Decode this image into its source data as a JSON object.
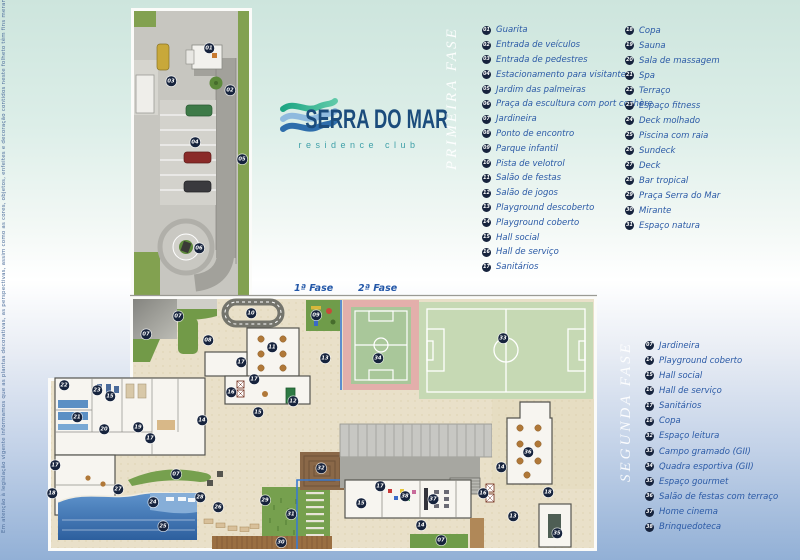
{
  "disclaimer": "Em atenção à legislação vigente informamos que as plantas decorativas, as perspectivas, assim como as cores, objetos, enfeites e decoração contidos neste folheto têm fins meramente ilustrativos, não integrando o contrato de compra e venda.",
  "logo": {
    "title": "SERRA DO MAR",
    "subtitle": "residence club"
  },
  "plan_labels": {
    "phase1": "1ª Fase",
    "phase2": "2ª Fase"
  },
  "colors": {
    "legend_text": "#2b5aa6",
    "badge_bg": "#16233d",
    "logo_title": "#1b4c7c",
    "logo_subtitle": "#3fa0a8",
    "wave_green": "#23b18c",
    "wave_light_blue": "#8fbade",
    "wave_blue": "#2e6dab",
    "phase2_boundary": "#3a7ad0"
  },
  "legend_primeira": {
    "title": "PRIMEIRA FASE",
    "col1": [
      {
        "n": "01",
        "label": "Guarita"
      },
      {
        "n": "02",
        "label": "Entrada de veículos"
      },
      {
        "n": "03",
        "label": "Entrada de pedestres"
      },
      {
        "n": "04",
        "label": "Estacionamento para visitantes"
      },
      {
        "n": "05",
        "label": "Jardim das palmeiras"
      },
      {
        "n": "06",
        "label": "Praça da escultura com port cochère"
      },
      {
        "n": "07",
        "label": "Jardineira"
      },
      {
        "n": "08",
        "label": "Ponto de encontro"
      },
      {
        "n": "09",
        "label": "Parque infantil"
      },
      {
        "n": "10",
        "label": "Pista de velotrol"
      },
      {
        "n": "11",
        "label": "Salão de festas"
      },
      {
        "n": "12",
        "label": "Salão de jogos"
      },
      {
        "n": "13",
        "label": "Playground descoberto"
      },
      {
        "n": "14",
        "label": "Playground coberto"
      },
      {
        "n": "15",
        "label": "Hall social"
      },
      {
        "n": "16",
        "label": "Hall de serviço"
      },
      {
        "n": "17",
        "label": "Sanitários"
      }
    ],
    "col2": [
      {
        "n": "18",
        "label": "Copa"
      },
      {
        "n": "19",
        "label": "Sauna"
      },
      {
        "n": "20",
        "label": "Sala de massagem"
      },
      {
        "n": "21",
        "label": "Spa"
      },
      {
        "n": "22",
        "label": "Terraço"
      },
      {
        "n": "23",
        "label": "Espaço fitness"
      },
      {
        "n": "24",
        "label": "Deck molhado"
      },
      {
        "n": "25",
        "label": "Piscina com raia"
      },
      {
        "n": "26",
        "label": "Sundeck"
      },
      {
        "n": "27",
        "label": "Deck"
      },
      {
        "n": "28",
        "label": "Bar tropical"
      },
      {
        "n": "29",
        "label": "Praça Serra do Mar"
      },
      {
        "n": "30",
        "label": "Mirante"
      },
      {
        "n": "31",
        "label": "Espaço natura"
      }
    ]
  },
  "legend_segunda": {
    "title": "SEGUNDA FASE",
    "items": [
      {
        "n": "07",
        "label": "Jardineira"
      },
      {
        "n": "14",
        "label": "Playground coberto"
      },
      {
        "n": "15",
        "label": "Hall social"
      },
      {
        "n": "16",
        "label": "Hall de serviço"
      },
      {
        "n": "17",
        "label": "Sanitários"
      },
      {
        "n": "18",
        "label": "Copa"
      },
      {
        "n": "32",
        "label": "Espaço leitura"
      },
      {
        "n": "33",
        "label": "Campo gramado (GII)"
      },
      {
        "n": "34",
        "label": "Quadra esportiva (GII)"
      },
      {
        "n": "35",
        "label": "Espaço gourmet"
      },
      {
        "n": "36",
        "label": "Salão de festas com terraço"
      },
      {
        "n": "37",
        "label": "Home cinema"
      },
      {
        "n": "38",
        "label": "Brinquedoteca"
      }
    ]
  },
  "badges": {
    "entry": [
      {
        "n": "01",
        "x": 209,
        "y": 48
      },
      {
        "n": "02",
        "x": 230,
        "y": 90
      },
      {
        "n": "03",
        "x": 171,
        "y": 81
      },
      {
        "n": "04",
        "x": 195,
        "y": 142
      },
      {
        "n": "05",
        "x": 242,
        "y": 159
      },
      {
        "n": "06",
        "x": 199,
        "y": 248
      }
    ],
    "main": [
      {
        "n": "07",
        "x": 178,
        "y": 316
      },
      {
        "n": "07",
        "x": 146,
        "y": 334
      },
      {
        "n": "07",
        "x": 176,
        "y": 474
      },
      {
        "n": "07",
        "x": 441,
        "y": 540
      },
      {
        "n": "08",
        "x": 208,
        "y": 340
      },
      {
        "n": "09",
        "x": 316,
        "y": 315
      },
      {
        "n": "10",
        "x": 251,
        "y": 313
      },
      {
        "n": "11",
        "x": 272,
        "y": 347
      },
      {
        "n": "12",
        "x": 293,
        "y": 401
      },
      {
        "n": "13",
        "x": 325,
        "y": 358
      },
      {
        "n": "13",
        "x": 513,
        "y": 516
      },
      {
        "n": "14",
        "x": 202,
        "y": 420
      },
      {
        "n": "14",
        "x": 421,
        "y": 525
      },
      {
        "n": "14",
        "x": 501,
        "y": 467
      },
      {
        "n": "15",
        "x": 258,
        "y": 412
      },
      {
        "n": "15",
        "x": 361,
        "y": 503
      },
      {
        "n": "15",
        "x": 110,
        "y": 396
      },
      {
        "n": "16",
        "x": 231,
        "y": 392
      },
      {
        "n": "16",
        "x": 483,
        "y": 493
      },
      {
        "n": "17",
        "x": 241,
        "y": 362
      },
      {
        "n": "17",
        "x": 254,
        "y": 379
      },
      {
        "n": "17",
        "x": 150,
        "y": 438
      },
      {
        "n": "17",
        "x": 55,
        "y": 465
      },
      {
        "n": "17",
        "x": 380,
        "y": 486
      },
      {
        "n": "18",
        "x": 52,
        "y": 493
      },
      {
        "n": "18",
        "x": 548,
        "y": 492
      },
      {
        "n": "19",
        "x": 138,
        "y": 427
      },
      {
        "n": "20",
        "x": 104,
        "y": 429
      },
      {
        "n": "21",
        "x": 77,
        "y": 417
      },
      {
        "n": "22",
        "x": 64,
        "y": 385
      },
      {
        "n": "23",
        "x": 97,
        "y": 390
      },
      {
        "n": "24",
        "x": 153,
        "y": 502
      },
      {
        "n": "25",
        "x": 163,
        "y": 526
      },
      {
        "n": "26",
        "x": 218,
        "y": 507
      },
      {
        "n": "27",
        "x": 118,
        "y": 489
      },
      {
        "n": "28",
        "x": 200,
        "y": 497
      },
      {
        "n": "29",
        "x": 265,
        "y": 500
      },
      {
        "n": "30",
        "x": 281,
        "y": 542
      },
      {
        "n": "31",
        "x": 291,
        "y": 514
      },
      {
        "n": "32",
        "x": 321,
        "y": 468
      },
      {
        "n": "33",
        "x": 503,
        "y": 338
      },
      {
        "n": "34",
        "x": 378,
        "y": 358
      },
      {
        "n": "35",
        "x": 557,
        "y": 533
      },
      {
        "n": "36",
        "x": 528,
        "y": 452
      },
      {
        "n": "37",
        "x": 433,
        "y": 499
      },
      {
        "n": "38",
        "x": 405,
        "y": 496
      }
    ]
  }
}
